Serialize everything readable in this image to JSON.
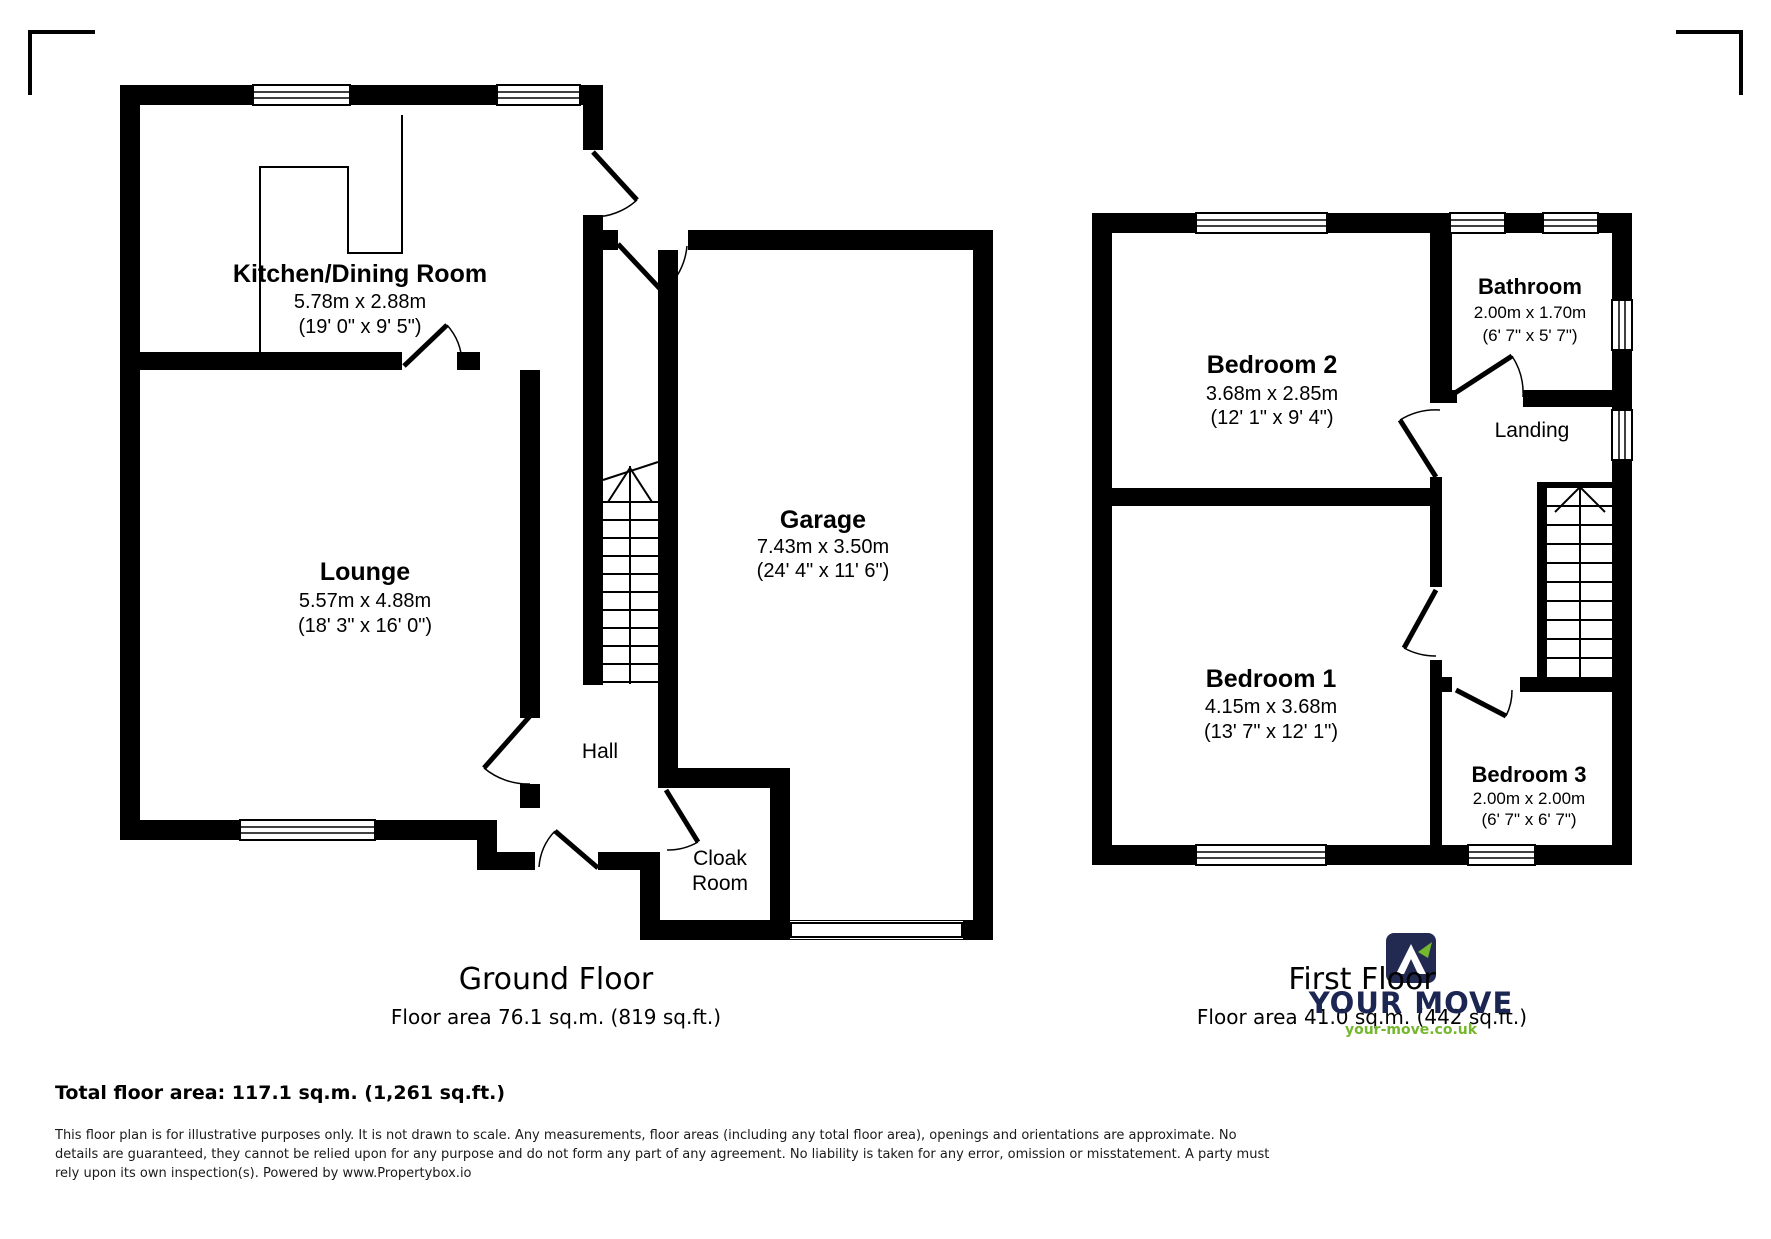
{
  "ground_floor": {
    "title": "Ground Floor",
    "area": "Floor area 76.1 sq.m. (819 sq.ft.)",
    "rooms": {
      "kitchen": {
        "name": "Kitchen/Dining Room",
        "metric": "5.78m x 2.88m",
        "imperial": "(19' 0\" x 9' 5\")"
      },
      "lounge": {
        "name": "Lounge",
        "metric": "5.57m x 4.88m",
        "imperial": "(18' 3\" x 16' 0\")"
      },
      "garage": {
        "name": "Garage",
        "metric": "7.43m x 3.50m",
        "imperial": "(24' 4\" x 11' 6\")"
      },
      "hall": {
        "name": "Hall"
      },
      "cloak_room": {
        "line1": "Cloak",
        "line2": "Room"
      }
    }
  },
  "first_floor": {
    "title": "First Floor",
    "area": "Floor area 41.0 sq.m. (442 sq.ft.)",
    "rooms": {
      "bedroom2": {
        "name": "Bedroom 2",
        "metric": "3.68m x 2.85m",
        "imperial": "(12' 1\" x 9' 4\")"
      },
      "bathroom": {
        "name": "Bathroom",
        "metric": "2.00m x 1.70m",
        "imperial": "(6' 7\" x 5' 7\")"
      },
      "landing": {
        "name": "Landing"
      },
      "bedroom1": {
        "name": "Bedroom 1",
        "metric": "4.15m x 3.68m",
        "imperial": "(13' 7\" x 12' 1\")"
      },
      "bedroom3": {
        "name": "Bedroom 3",
        "metric": "2.00m x 2.00m",
        "imperial": "(6' 7\" x 6' 7\")"
      }
    }
  },
  "summary": {
    "total": "Total floor area: 117.1 sq.m. (1,261 sq.ft.)"
  },
  "disclaimer": "This floor plan is for illustrative purposes only. It is not drawn to scale. Any measurements, floor areas (including any total floor area), openings and orientations are approximate. No details are guaranteed, they cannot be relied upon for any purpose and do not form any part of any agreement. No liability is taken for any error, omission or misstatement. A party must rely upon its own inspection(s). Powered by www.Propertybox.io",
  "logo": {
    "brand": "YOUR MOVE",
    "website": "your-move.co.uk",
    "navy": "#1b2653",
    "green": "#74b62c"
  }
}
